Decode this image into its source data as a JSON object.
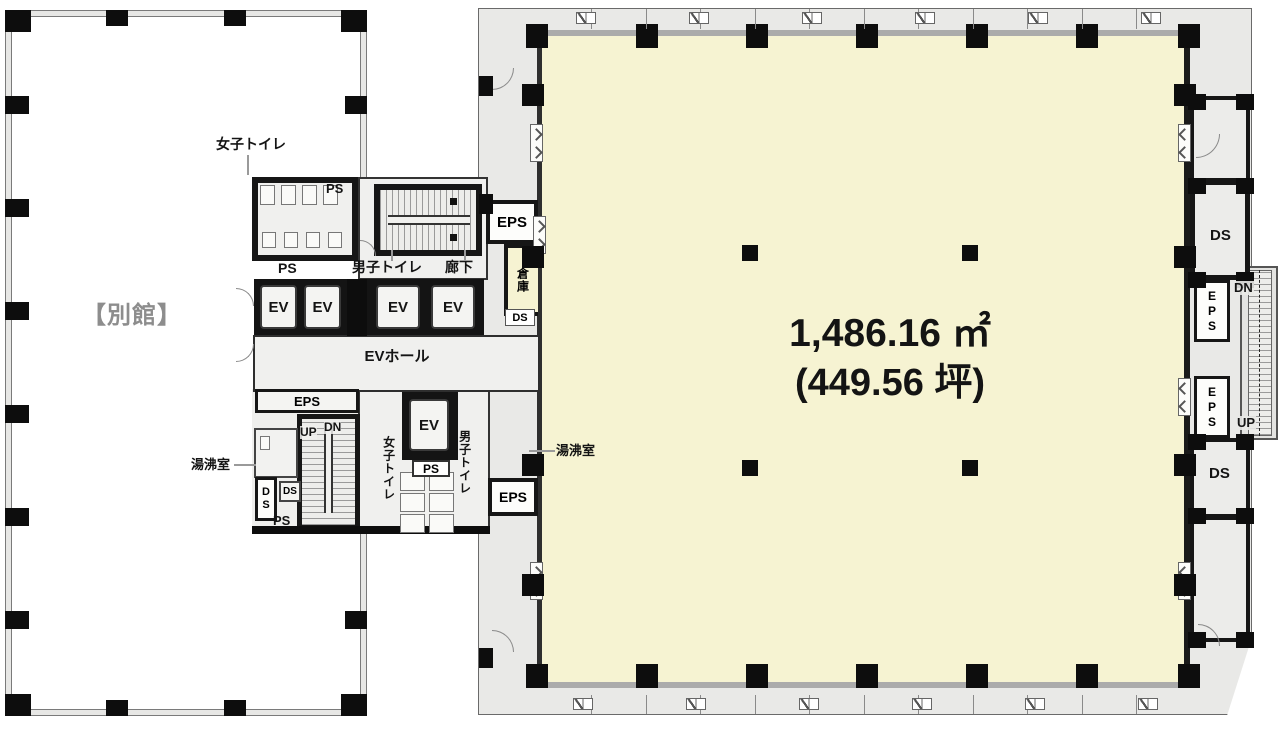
{
  "annex": {
    "label": "【別館】"
  },
  "main_room": {
    "area_m2": "1,486.16 ㎡",
    "area_tsubo": "(449.56 坪)"
  },
  "labels": {
    "women_toilet": "女子トイレ",
    "men_toilet": "男子トイレ",
    "corridor": "廊下",
    "storage": "倉庫",
    "ev": "EV",
    "ev_hall": "EVホール",
    "ps": "PS",
    "eps": "EPS",
    "ds": "DS",
    "up": "UP",
    "dn": "DN",
    "kettle_room": "湯沸室"
  },
  "colors": {
    "floor_yellow": "#f6f3d2",
    "facade_gray": "#e9e9e7",
    "wall_black": "#161616",
    "annex_label_gray": "#8d8d8d"
  }
}
